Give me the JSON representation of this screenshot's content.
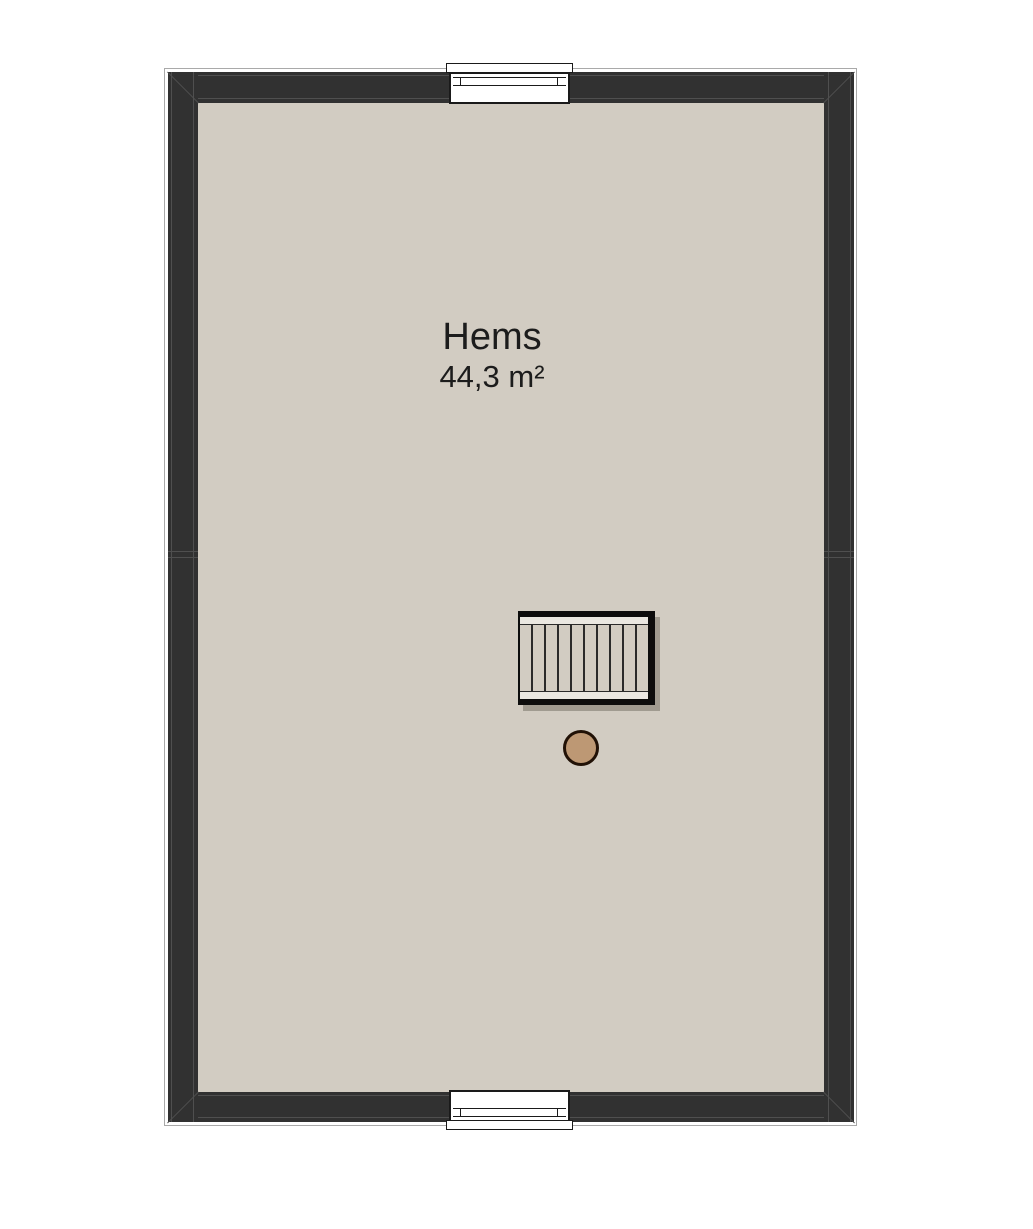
{
  "room": {
    "name": "Hems",
    "area": "44,3 m²"
  },
  "colors": {
    "background": "#ffffff",
    "wall": "#313131",
    "wall_line": "#4f4f4f",
    "floor": "#d2ccc2",
    "stair_stringer": "#eae7e1",
    "stair_border": "#0d0d0d",
    "stair_line": "#2a2a2a",
    "column_fill": "#bd9874",
    "column_border": "#211106",
    "window_frame": "#1a1a1a",
    "outline": "#a9a9a9",
    "text": "#1c1c1c"
  },
  "elements": {
    "stair_treads": 10,
    "windows": [
      "top",
      "bottom"
    ],
    "column_count": 1
  }
}
